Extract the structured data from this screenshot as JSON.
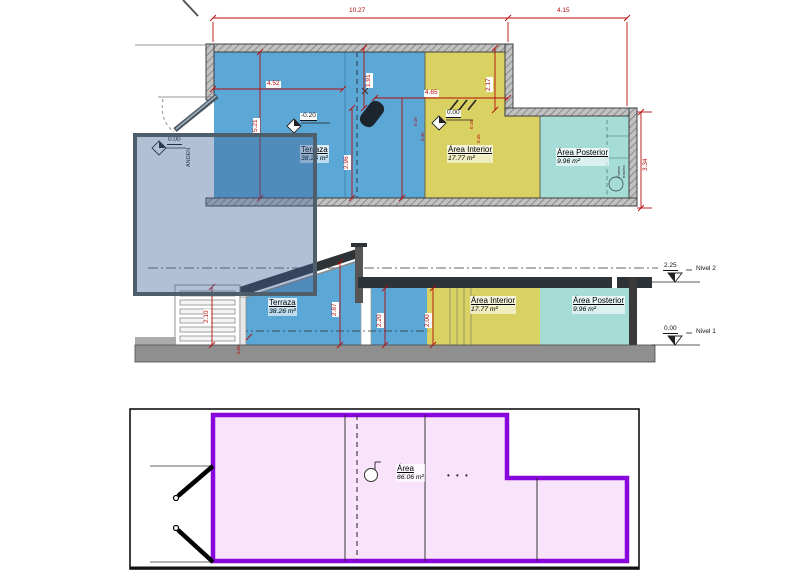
{
  "drawing_type": "architectural plan, section and footprint diagram",
  "rooms": {
    "terraza": {
      "name": "Terraza",
      "area": "38.26 m²"
    },
    "interior": {
      "name": "Área Interior",
      "area": "17.77 m²"
    },
    "posterior": {
      "name": "Área Posterior",
      "area": "9.96 m²"
    },
    "total": {
      "name": "Área",
      "area": "66.06 m²"
    }
  },
  "plan": {
    "dims": {
      "total": "10.27",
      "right_wing": "4.15",
      "terraza_w": "4.52",
      "interior_w": "4.65",
      "height": "5.21",
      "front": "1.91",
      "back": "2.96",
      "notch": "2.17",
      "posterior_h": "3.34",
      "tiny1": "0.16",
      "tiny2": "0.45",
      "tiny3": "0.16",
      "tiny4": "0.45"
    },
    "levels": {
      "anden": {
        "value": "0.00",
        "label": "ANDEN"
      },
      "terraza": "-0.20",
      "interior": "0.00"
    },
    "wall_note": {
      "l1": "Puerta",
      "l2": "trasera"
    }
  },
  "section": {
    "dims": {
      "gate": "2.10",
      "terraza": "2.87",
      "mid": "2.20",
      "interior": "2.00",
      "floor": "0.05"
    },
    "levels": [
      {
        "elev": "2.25",
        "name": "Nivel 2"
      },
      {
        "elev": "0.00",
        "name": "Nivel 1"
      }
    ]
  },
  "bottom": {
    "dots": "• • •"
  },
  "palette": {
    "plan_blue": "#5ba8d6",
    "interior_yellow": "#d9d161",
    "posterior_teal": "#a6dcd6",
    "wall_gray": "#b5b5b5",
    "dim_red": "#b50d0d",
    "outline_purple": "#8807dc",
    "footprint_fill": "#f8e3fa",
    "selection_fill": "rgba(62,98,150,0.40)",
    "selection_border": "#4f5e6b"
  }
}
